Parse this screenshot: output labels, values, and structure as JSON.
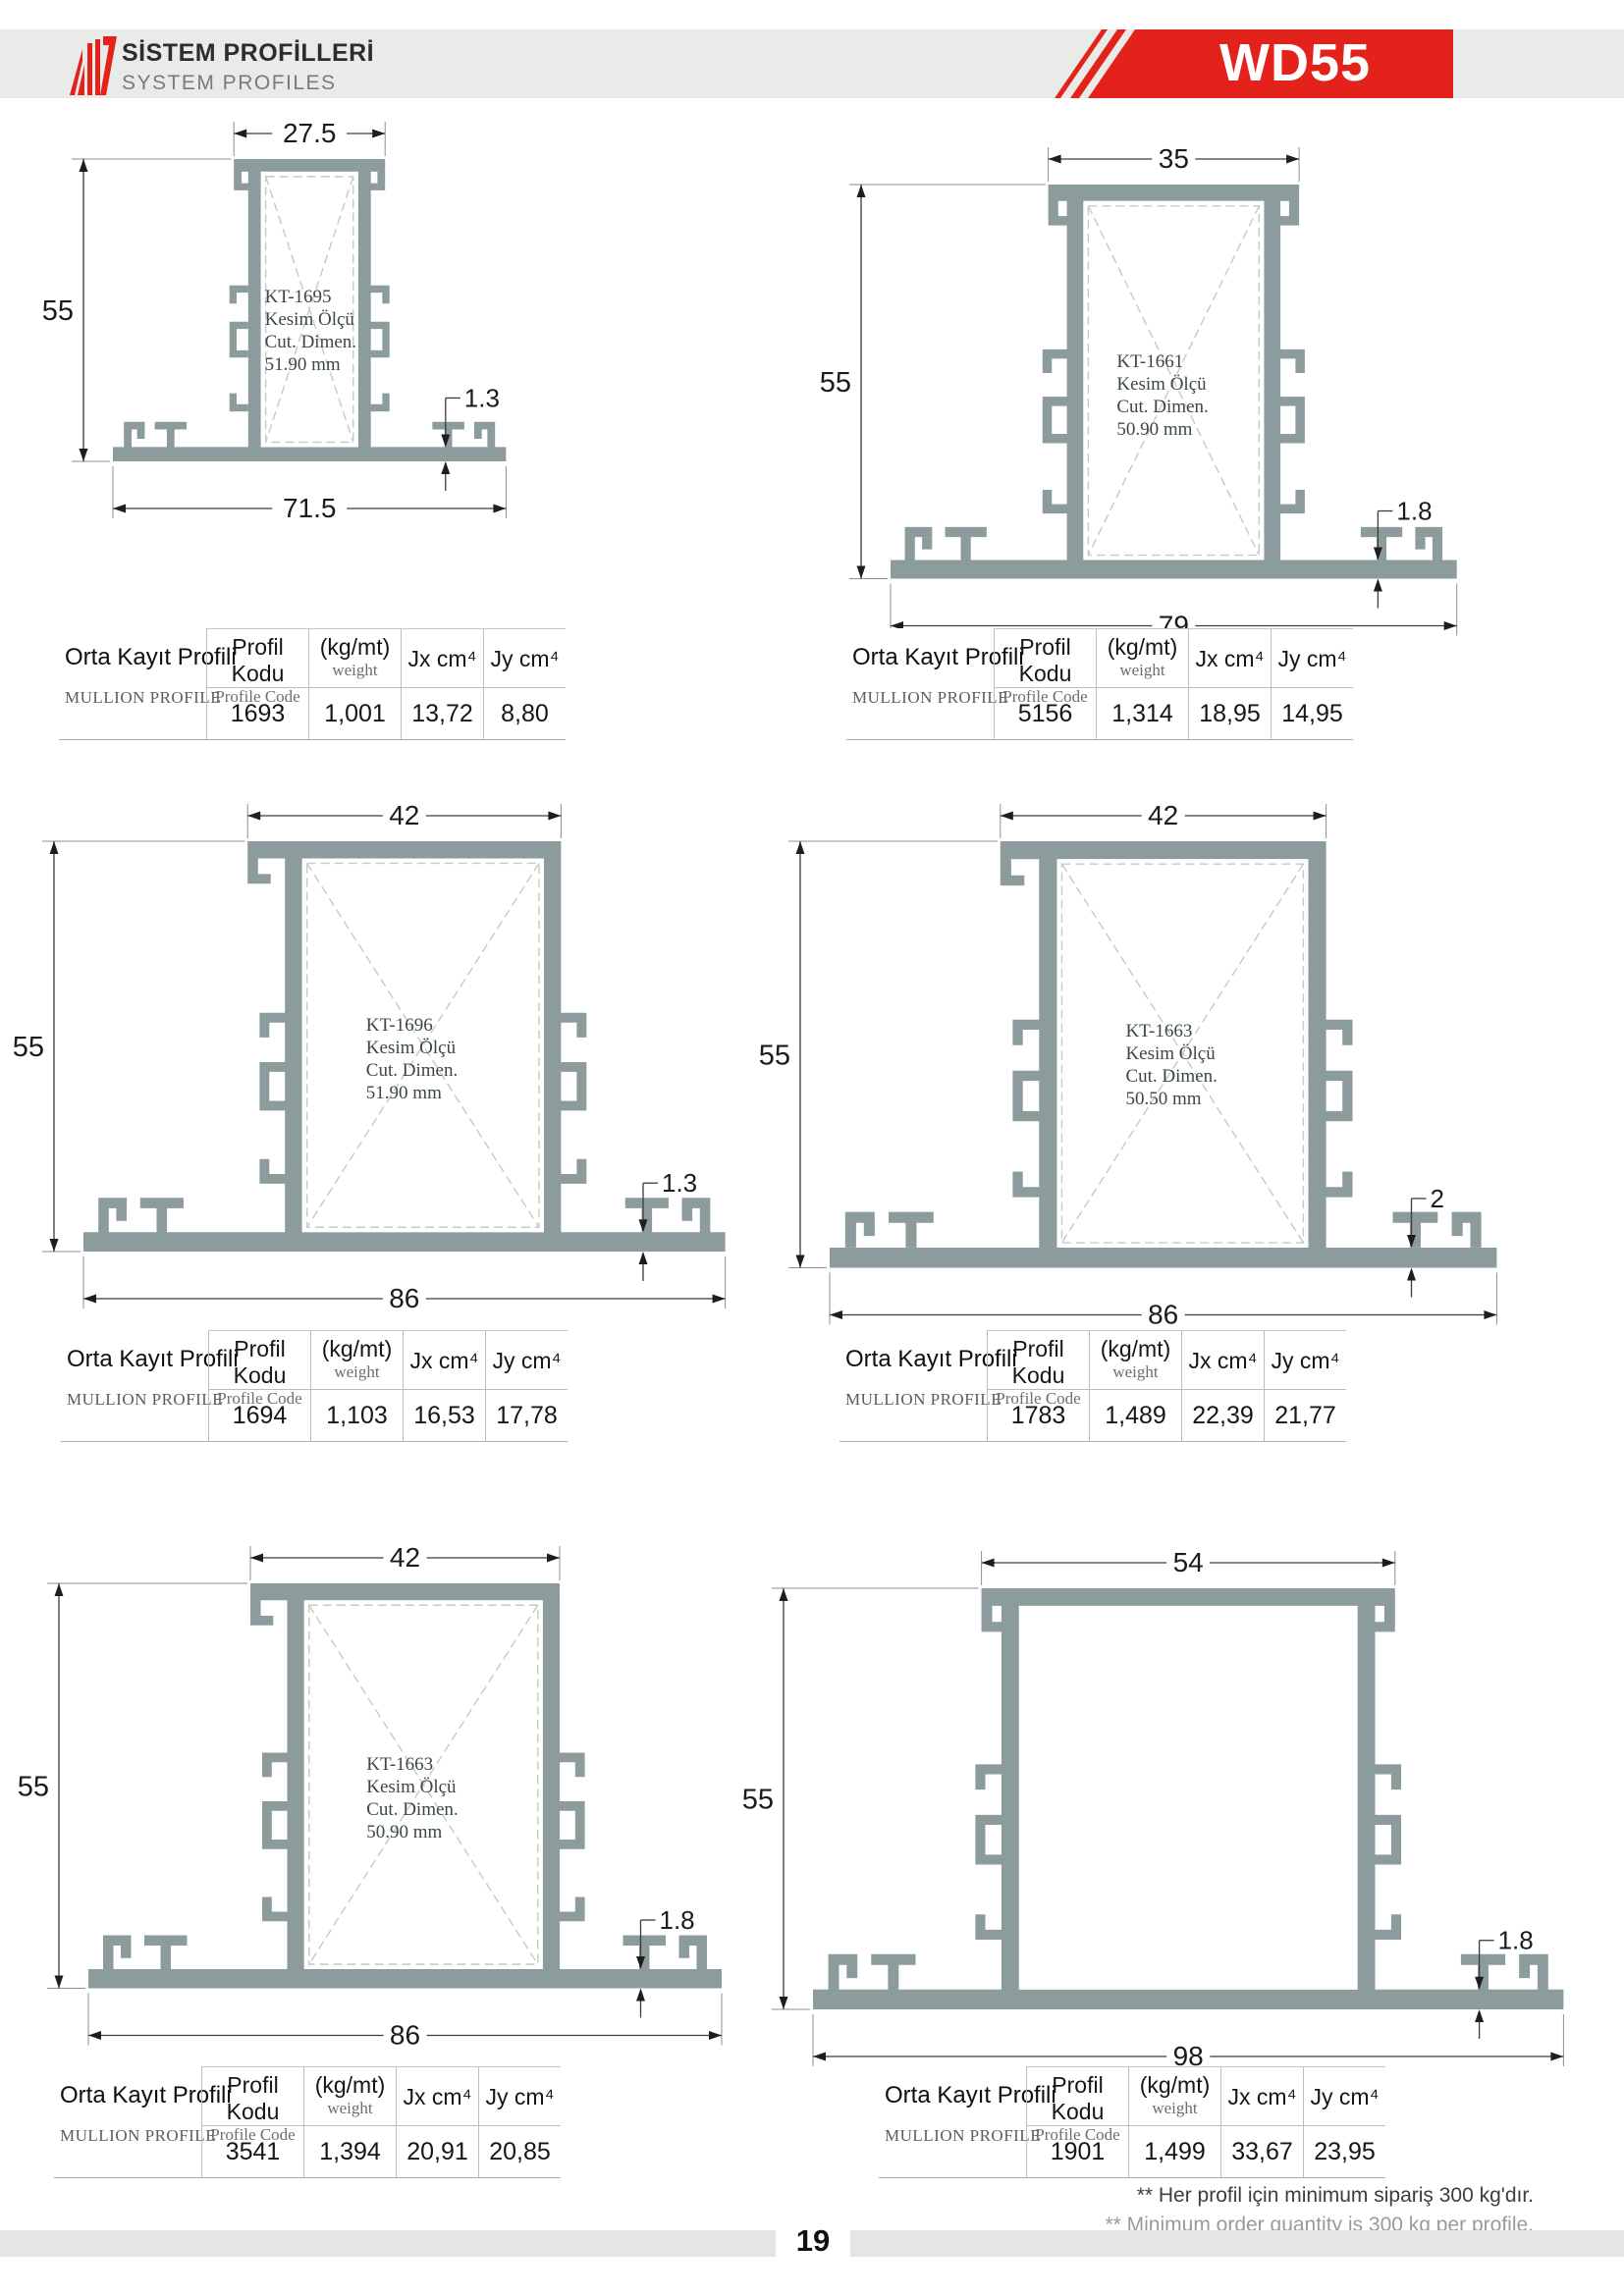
{
  "header": {
    "title_tr": "SİSTEM PROFİLLERİ",
    "title_en": "SYSTEM PROFILES",
    "series": "WD55",
    "brand_red": "#e3231b",
    "band_gray": "#e9ebe8"
  },
  "profile_color": "#8c9b9b",
  "table_headers": {
    "row_title_tr": "Orta Kayıt Profili",
    "row_title_en": "MULLION PROFILE",
    "col_code_tr": "Profil Kodu",
    "col_code_en": "Profile Code",
    "col_weight_tr": "(kg/mt)",
    "col_weight_en": "weight",
    "col_jx": "Jx cm⁴",
    "col_jy": "Jy cm⁴"
  },
  "sections": [
    {
      "label": [
        "KT-1695",
        "Kesim Ölçü",
        "Cut. Dimen.",
        "51.90 mm"
      ],
      "dims": {
        "top": "27.5",
        "height": "55",
        "base": "71.5",
        "thickness": "1.3"
      },
      "values": {
        "code": "1693",
        "weight": "1,001",
        "jx": "13,72",
        "jy": "8,80"
      }
    },
    {
      "label": [
        "KT-1661",
        "Kesim Ölçü",
        "Cut. Dimen.",
        "50.90 mm"
      ],
      "dims": {
        "top": "35",
        "height": "55",
        "base": "79",
        "thickness": "1.8"
      },
      "values": {
        "code": "5156",
        "weight": "1,314",
        "jx": "18,95",
        "jy": "14,95"
      }
    },
    {
      "label": [
        "KT-1696",
        "Kesim Ölçü",
        "Cut. Dimen.",
        "51.90 mm"
      ],
      "dims": {
        "top": "42",
        "height": "55",
        "base": "86",
        "thickness": "1.3"
      },
      "values": {
        "code": "1694",
        "weight": "1,103",
        "jx": "16,53",
        "jy": "17,78"
      }
    },
    {
      "label": [
        "KT-1663",
        "Kesim Ölçü",
        "Cut. Dimen.",
        "50.50 mm"
      ],
      "dims": {
        "top": "42",
        "height": "55",
        "base": "86",
        "thickness": "2"
      },
      "values": {
        "code": "1783",
        "weight": "1,489",
        "jx": "22,39",
        "jy": "21,77"
      }
    },
    {
      "label": [
        "KT-1663",
        "Kesim Ölçü",
        "Cut. Dimen.",
        "50.90 mm"
      ],
      "dims": {
        "top": "42",
        "height": "55",
        "base": "86",
        "thickness": "1.8"
      },
      "values": {
        "code": "3541",
        "weight": "1,394",
        "jx": "20,91",
        "jy": "20,85"
      }
    },
    {
      "label": null,
      "dims": {
        "top": "54",
        "height": "55",
        "base": "98",
        "thickness": "1.8"
      },
      "values": {
        "code": "1901",
        "weight": "1,499",
        "jx": "33,67",
        "jy": "23,95"
      }
    }
  ],
  "footnotes": [
    "** Her profil için minimum sipariş 300 kg'dır.",
    "** Minimum order quantity is 300 kg per profile."
  ],
  "page_number": "19"
}
